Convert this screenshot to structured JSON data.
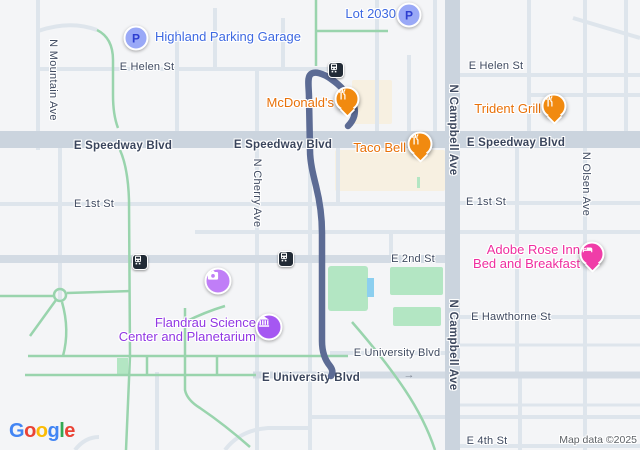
{
  "attribution": "Map data ©2025",
  "parking_letter": "P",
  "one_way_arrow": "→",
  "streets": {
    "helen_w": "E Helen St",
    "helen_e": "E Helen St",
    "speedway_w": "E Speedway Blvd",
    "speedway_c": "E Speedway Blvd",
    "speedway_e": "E Speedway Blvd",
    "first_w": "E 1st St",
    "first_e": "E 1st St",
    "second": "E 2nd St",
    "hawthorne": "E Hawthorne St",
    "university_n": "E University Blvd",
    "university_s": "E University Blvd",
    "fourth": "E 4th St",
    "mountain": "N Mountain Ave",
    "cherry": "N Cherry Ave",
    "campbell_n": "N Campbell Ave",
    "campbell_s": "N Campbell Ave",
    "olsen": "N Olsen Ave"
  },
  "pois": {
    "highland": {
      "name": "Highland Parking Garage"
    },
    "lot_2030": {
      "name": "Lot 2030"
    },
    "mcdonalds": {
      "name": "McDonald's"
    },
    "taco_bell": {
      "name": "Taco Bell"
    },
    "trident_grill": {
      "name": "Trident Grill"
    },
    "adobe_rose": {
      "line1": "Adobe Rose Inn",
      "line2": "Bed and Breakfast"
    },
    "flandrau": {
      "line1": "Flandrau Science",
      "line2": "Center and Planetarium"
    }
  },
  "colors": {
    "background": "#f4f5f7",
    "road_major": "#cbd4de",
    "road_mid": "#d3dbe4",
    "road_minor": "#dee5ec",
    "green_path": "#99d4ad",
    "park": "#b3e6c3",
    "commercial_beige": "#f7f0e1",
    "water": "#8ccfef",
    "route": "#5c6b94",
    "poi_blue": "#3e69e1",
    "poi_orange": "#e8710a",
    "poi_pink": "#ef2d9f",
    "poi_purple": "#9137e3",
    "pin_orange": "#f18a10",
    "pin_pink": "#f03da8",
    "icon_museum_purple": "#a557f2",
    "icon_camera_purple": "#c07ef7",
    "parking_fill": "#9aa9f7",
    "parking_letter_color": "#2d3ed0",
    "transit_dark": "#222b36",
    "street_label": "#3f4a60",
    "attribution_gray": "#5f6368"
  },
  "logo": {
    "letters": [
      "G",
      "o",
      "o",
      "g",
      "l",
      "e"
    ],
    "colors": [
      "#4285F4",
      "#EA4335",
      "#FBBC05",
      "#4285F4",
      "#34A853",
      "#EA4335"
    ]
  }
}
